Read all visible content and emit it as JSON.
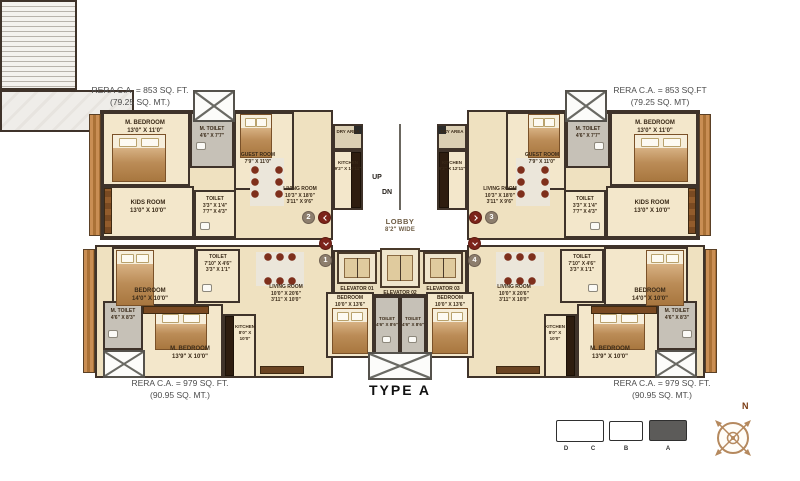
{
  "plan": {
    "title": "TYPE A",
    "flats": {
      "f1": "1",
      "f2": "2",
      "f3": "3",
      "f4": "4"
    },
    "core": {
      "up": "UP",
      "dn": "DN",
      "lobby_name": "LOBBY",
      "lobby_dims": "8'2\" WIDE",
      "elevator_01": "ELEVATOR 01",
      "elevator_02": "ELEVATOR 02",
      "elevator_03": "ELEVATOR 03"
    },
    "units": {
      "top_left": {
        "rera1": "RERA C.A. = 853 SQ. FT.",
        "rera2": "(79.25 SQ. MT.)",
        "rooms": {
          "m_bedroom": {
            "name": "M. BEDROOM",
            "dims": "13'0\" X 11'0\""
          },
          "m_toilet": {
            "name": "M. TOILET",
            "dims": "4'6\" X 7'7\""
          },
          "guest_room": {
            "name": "GUEST ROOM",
            "dims": "7'9\" X 11'0\""
          },
          "kids_room": {
            "name": "KIDS ROOM",
            "dims": "13'0\" X 10'0\""
          },
          "toilet": {
            "name": "TOILET",
            "dims": "3'3\" X 1'4\"",
            "dims2": "7'7\" X 4'3\""
          },
          "living_room": {
            "name": "LIVING ROOM",
            "dims": "10'3\" X 18'0\"",
            "dims2": "3'11\" X 9'6\""
          },
          "kitchen": {
            "name": "KITCHEN",
            "dims": "9'2\" X 12'11\""
          },
          "dry_area": {
            "name": "DRY AREA"
          }
        }
      },
      "top_right": {
        "rera1": "RERA C.A. = 853 SQ.FT",
        "rera2": "(79.25 SQ. MT)",
        "rooms": {
          "m_bedroom": {
            "name": "M. BEDROOM",
            "dims": "13'0\" X 11'0\""
          },
          "m_toilet": {
            "name": "M. TOILET",
            "dims": "4'6\" X 7'7\""
          },
          "guest_room": {
            "name": "GUEST ROOM",
            "dims": "7'9\" X 11'0\""
          },
          "kids_room": {
            "name": "KIDS ROOM",
            "dims": "13'0\" X 10'0\""
          },
          "toilet": {
            "name": "TOILET",
            "dims": "3'3\" X 1'4\"",
            "dims2": "7'7\" X 4'3\""
          },
          "living_room": {
            "name": "LIVING ROOM",
            "dims": "10'3\" X 18'0\"",
            "dims2": "3'11\" X 9'6\""
          },
          "kitchen": {
            "name": "KITCHEN",
            "dims": "9'2\" X 12'11\""
          },
          "dry_area": {
            "name": "DRY AREA"
          }
        }
      },
      "bottom_left": {
        "rera1": "RERA C.A. = 979 SQ. FT.",
        "rera2": "(90.95 SQ. MT.)",
        "rooms": {
          "bedroom": {
            "name": "BEDROOM",
            "dims": "14'0\" X 10'0\""
          },
          "toilet": {
            "name": "TOILET",
            "dims": "7'10\" X 4'6\"",
            "dims2": "3'3\" X 1'1\""
          },
          "living_room": {
            "name": "LIVING ROOM",
            "dims": "10'0\" X 20'6\"",
            "dims2": "3'11\" X 10'0\""
          },
          "m_toilet": {
            "name": "M. TOILET",
            "dims": "4'6\" X 8'3\""
          },
          "m_bedroom": {
            "name": "M. BEDROOM",
            "dims": "13'9\" X 10'0\""
          },
          "kitchen": {
            "name": "KITCHEN",
            "dims": "8'0\" X 10'0\""
          },
          "bedroom2": {
            "name": "BEDROOM",
            "dims": "10'0\" X 13'6\""
          },
          "toilet2": {
            "name": "TOILET",
            "dims": "4'6\" X 8'6\""
          }
        }
      },
      "bottom_right": {
        "rera1": "RERA C.A. = 979 SQ. FT.",
        "rera2": "(90.95 SQ. MT.)",
        "rooms": {
          "bedroom": {
            "name": "BEDROOM",
            "dims": "14'0\" X 10'0\""
          },
          "toilet": {
            "name": "TOILET",
            "dims": "7'10\" X 4'6\"",
            "dims2": "3'3\" X 1'1\""
          },
          "living_room": {
            "name": "LIVING ROOM",
            "dims": "10'0\" X 20'6\"",
            "dims2": "3'11\" X 10'0\""
          },
          "m_toilet": {
            "name": "M. TOILET",
            "dims": "4'6\" X 8'3\""
          },
          "m_bedroom": {
            "name": "M. BEDROOM",
            "dims": "13'9\" X 10'0\""
          },
          "kitchen": {
            "name": "KITCHEN",
            "dims": "8'0\" X 10'0\""
          },
          "bedroom2": {
            "name": "BEDROOM",
            "dims": "10'0\" X 13'6\""
          },
          "toilet2": {
            "name": "TOILET",
            "dims": "4'6\" X 8'6\""
          }
        }
      }
    },
    "key_plan": {
      "d": "D",
      "c": "C",
      "b": "B",
      "a": "A"
    },
    "compass": {
      "north": "N"
    },
    "colors": {
      "wall": "#3f332a",
      "floor": "#f0e3c6",
      "toilet_floor": "#c6c1b7",
      "marker_red": "#7c241a",
      "marker_taupe": "#8d7e6d",
      "keyplan_highlight": "#5c5b59"
    }
  }
}
